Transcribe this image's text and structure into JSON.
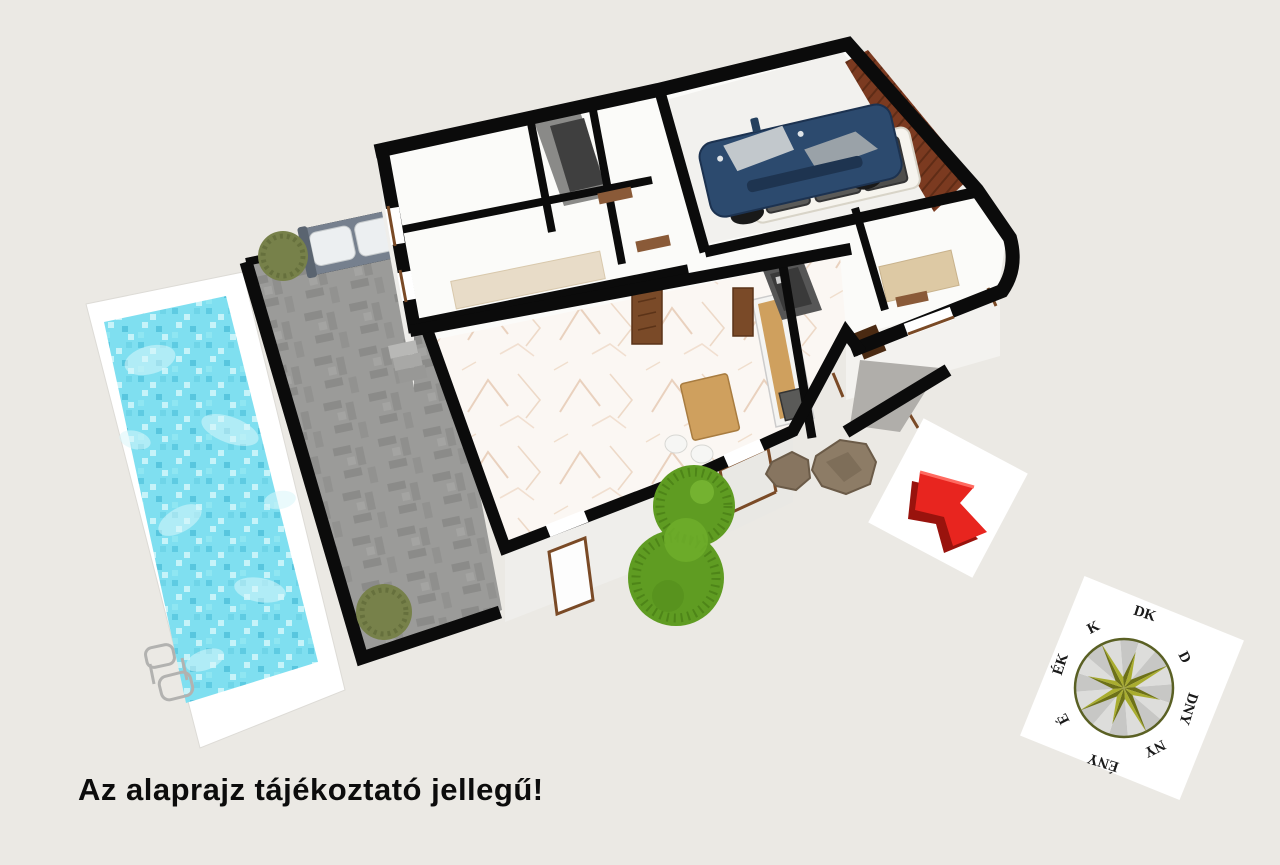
{
  "disclaimer": "Az alaprajz tájékoztató jellegű!",
  "compass": {
    "labels": [
      "K",
      "DK",
      "D",
      "DNY",
      "NY",
      "ÉNY",
      "É",
      "ÉK"
    ],
    "card_color": "#ffffff",
    "wedge_light": "#dddddb",
    "wedge_dark": "#c7c7c5",
    "ring_color": "#5a6024",
    "star_light": "#a9ad2f",
    "star_dark": "#6d7118",
    "label_color": "#1a1a1a"
  },
  "arrow_marker": {
    "direction": "up-left",
    "color": "#e8251f",
    "shadow": "#99130d",
    "card_color": "#ffffff"
  },
  "scene": {
    "background": "#ebe9e4",
    "wall_color": "#0b0b0b",
    "pool": {
      "water": "#7fdff0",
      "tile_dark": "#5ecbe2",
      "tile_light": "#c6f3f9",
      "deck": "#ffffff",
      "ladder": "#b2b2b0"
    },
    "terrace": {
      "paving": "#9b9b99",
      "paving_dark": "#8b8b89"
    },
    "house": {
      "floor": "#fbfbf9",
      "wall_face": "#efeeeb",
      "marble": "#fbf7f3",
      "marble_vein": "#dbb392",
      "garage_floor": "#f2f1ee",
      "garage_door": "#7b3a20",
      "door": "#8a5a38",
      "front_door": "#4a2a12",
      "window_trim": "#7a4a26",
      "dark_hall": "#3f3f3f",
      "bath_dark": "#3a3a3a"
    },
    "furniture": {
      "bench_frame": "#76808e",
      "bench_cushion": "#eceff1",
      "counter": "#f4f4f2",
      "counter_wood": "#cfa05e",
      "appliance": "#5a5a58",
      "table_wood": "#cfa05e",
      "bed": "#ddc9a4",
      "car_body": "#2c4a6e",
      "car_glass": "#c2c8cc",
      "trailer_body": "#f6f4ee",
      "trailer_panel": "#5a5a58"
    },
    "landscape": {
      "tree": "#5f9c22",
      "tree_dark": "#4a8016",
      "bush": "#77814a",
      "rock": "#877560",
      "rock_dark": "#6b5b48",
      "steps": "#a8a8a6",
      "driveway": "#b0aeaa"
    }
  }
}
